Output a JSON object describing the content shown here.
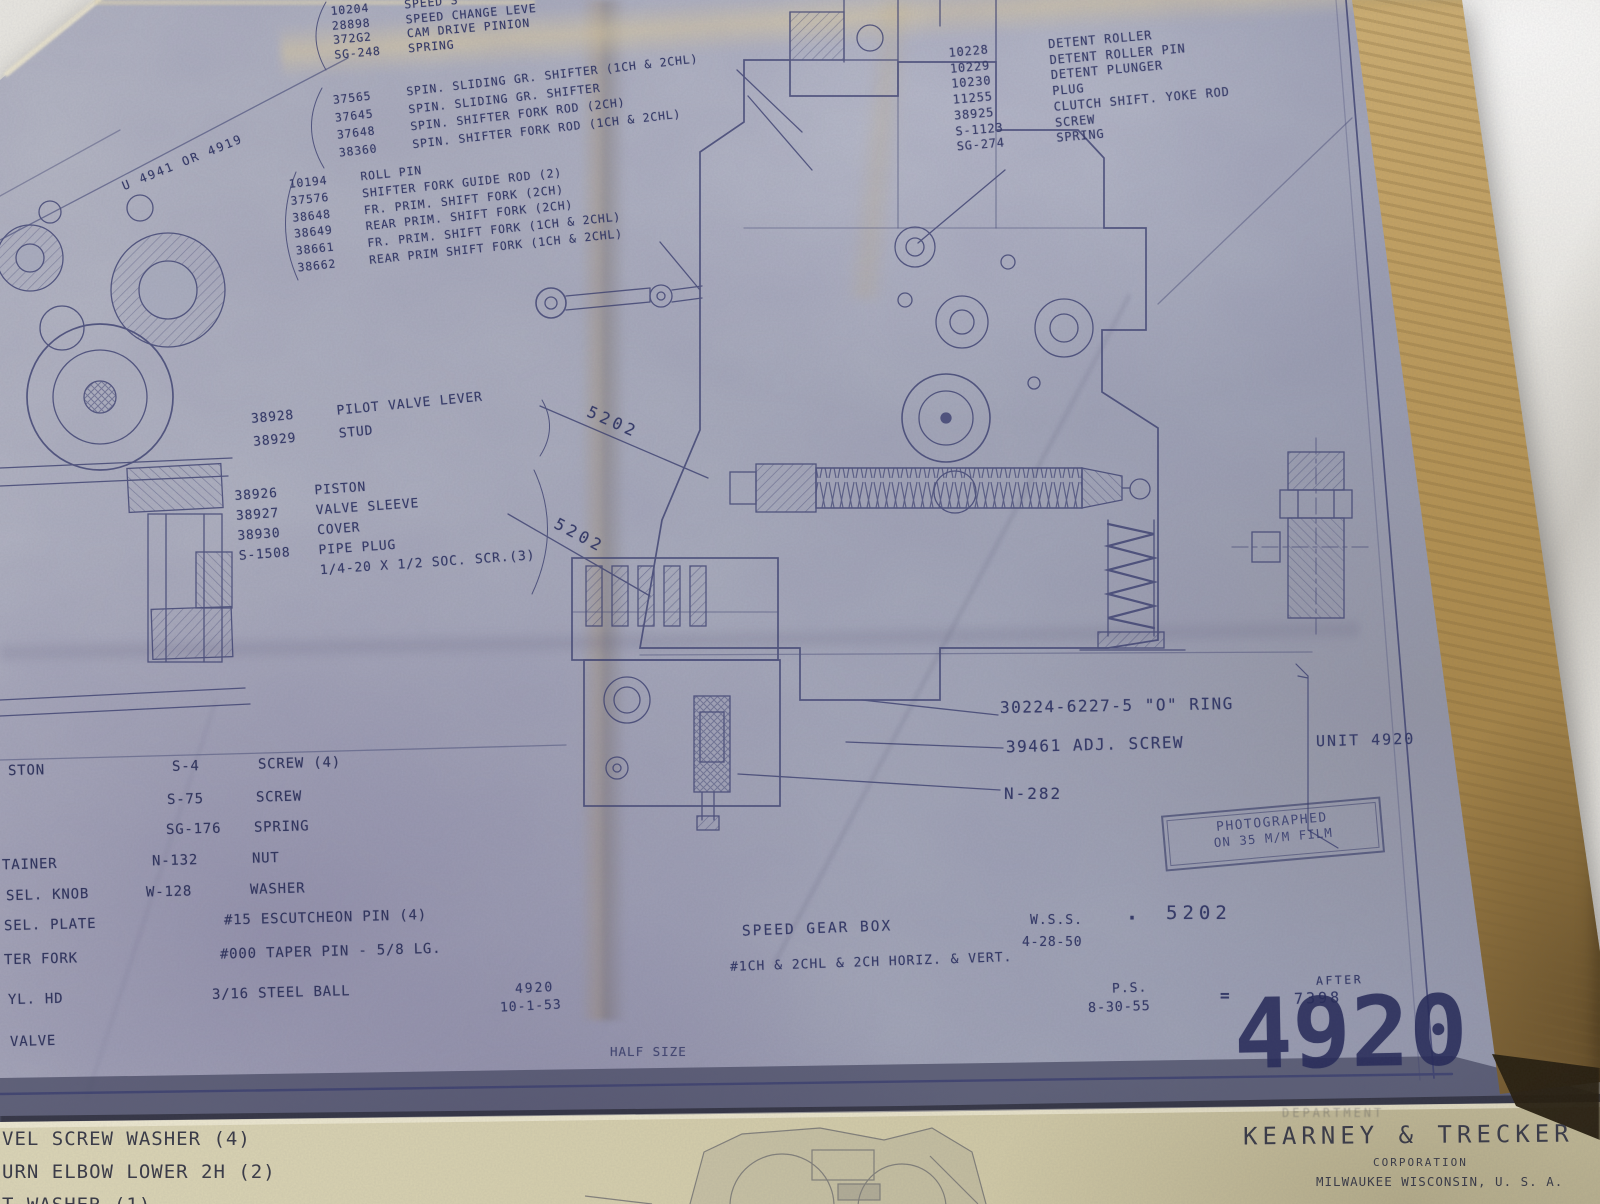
{
  "colors": {
    "ink": "#383c68",
    "paper_blue": "#a8abbc",
    "paper_tan_edge": "#c5a465",
    "marble_surface": "#e9e7e1",
    "second_sheet_cream": "#d8d3b2",
    "second_sheet_ink": "#3a3b47"
  },
  "blueprint": {
    "corner_ref": "U 4941 OR 4919",
    "lists": {
      "speed_change": {
        "rows": [
          {
            "num": "10204",
            "name": "SPEED S"
          },
          {
            "num": "28898",
            "name": "SPEED CHANGE LEVE"
          },
          {
            "num": "372G2",
            "name": "CAM DRIVE PINION"
          },
          {
            "num": "SG-248",
            "name": "SPRING"
          }
        ]
      },
      "spin_shifter": {
        "rows": [
          {
            "num": "37565",
            "name": "SPIN. SLIDING GR. SHIFTER (1CH & 2CHL)"
          },
          {
            "num": "37645",
            "name": "SPIN. SLIDING GR. SHIFTER"
          },
          {
            "num": "37648",
            "name": "SPIN. SHIFTER FORK ROD (2CH)"
          },
          {
            "num": "38360",
            "name": "SPIN. SHIFTER FORK ROD (1CH & 2CHL)"
          }
        ]
      },
      "shift_forks": {
        "rows": [
          {
            "num": "10194",
            "name": "ROLL PIN"
          },
          {
            "num": "37576",
            "name": "SHIFTER FORK GUIDE ROD (2)"
          },
          {
            "num": "38648",
            "name": "FR. PRIM. SHIFT FORK (2CH)"
          },
          {
            "num": "38649",
            "name": "REAR PRIM. SHIFT FORK (2CH)"
          },
          {
            "num": "38661",
            "name": "FR. PRIM. SHIFT FORK (1CH & 2CHL)"
          },
          {
            "num": "38662",
            "name": "REAR PRIM SHIFT FORK (1CH & 2CHL)"
          }
        ]
      },
      "detent": {
        "rows": [
          {
            "num": "10228",
            "name": "DETENT ROLLER"
          },
          {
            "num": "10229",
            "name": "DETENT ROLLER PIN"
          },
          {
            "num": "10230",
            "name": "DETENT PLUNGER"
          },
          {
            "num": "11255",
            "name": "PLUG"
          },
          {
            "num": "38925",
            "name": "CLUTCH SHIFT. YOKE ROD"
          },
          {
            "num": "S-1123",
            "name": "SCREW"
          },
          {
            "num": "SG-274",
            "name": "SPRING"
          }
        ]
      },
      "pilot_valve": {
        "rows": [
          {
            "num": "38928",
            "name": "PILOT VALVE LEVER"
          },
          {
            "num": "38929",
            "name": "STUD"
          }
        ]
      },
      "piston_group": {
        "rows": [
          {
            "num": "38926",
            "name": "PISTON"
          },
          {
            "num": "38927",
            "name": "VALVE SLEEVE"
          },
          {
            "num": "38930",
            "name": "COVER"
          },
          {
            "num": "S-1508",
            "name": "PIPE PLUG"
          },
          {
            "num": "",
            "name": "1/4-20 X 1/2 SOC. SCR.(3)"
          }
        ]
      },
      "bottom_left": {
        "rows": [
          {
            "frag": "STON",
            "num": "S-4",
            "name": "SCREW (4)"
          },
          {
            "frag": "",
            "num": "S-75",
            "name": "SCREW"
          },
          {
            "frag": "",
            "num": "SG-176",
            "name": "SPRING"
          },
          {
            "frag": "TAINER",
            "num": "N-132",
            "name": "NUT"
          },
          {
            "frag": "SEL. KNOB",
            "num": "W-128",
            "name": "WASHER"
          },
          {
            "frag": "SEL. PLATE",
            "num": "",
            "name": "#15 ESCUTCHEON PIN (4)"
          },
          {
            "frag": "TER FORK",
            "num": "",
            "name": "#000 TAPER PIN - 5/8 LG."
          },
          {
            "frag": "YL. HD",
            "num": "",
            "name": "3/16 STEEL BALL"
          },
          {
            "frag": "VALVE",
            "num": "",
            "name": ""
          }
        ]
      }
    },
    "callouts": {
      "leader_a": "5202",
      "leader_b": "5202",
      "o_ring": "30224-6227-5 \"O\" RING",
      "adj_screw": "39461 ADJ. SCREW",
      "n_nut": "N-282",
      "unit": "UNIT 4920"
    },
    "stamp": {
      "line1": "PHOTOGRAPHED",
      "line2": "ON 35 M/M FILM"
    },
    "title_block": {
      "title": "SPEED GEAR BOX",
      "subtitle": "#1CH & 2CHL & 2CH HORIZ. & VERT.",
      "wss_label": "W.S.S.",
      "wss_date": "4-28-50",
      "dot": "·",
      "sheet_ref": "5202",
      "ps_label": "P.S.",
      "ps_date": "8-30-55",
      "equals": "=",
      "after_label": "AFTER",
      "after_number": "7398",
      "rev_number": "4920",
      "rev_date": "10-1-53",
      "scale_note": "HALF SIZE",
      "big_number": "4920"
    }
  },
  "second_sheet": {
    "lines": [
      {
        "text": "VEL SCREW WASHER (4)"
      },
      {
        "text": "URN ELBOW LOWER 2H (2)"
      },
      {
        "text": "T WASHER (1)"
      }
    ],
    "dept": "DEPARTMENT",
    "company": "KEARNEY & TRECKER",
    "company_type": "CORPORATION",
    "company_location": "MILWAUKEE WISCONSIN, U. S. A."
  }
}
